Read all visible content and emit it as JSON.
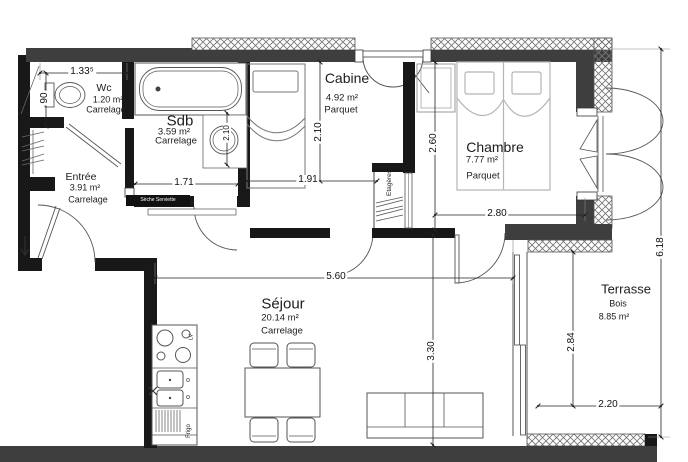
{
  "rooms": {
    "wc": {
      "name": "Wc",
      "area": "1.20 m²",
      "floor": "Carrelage"
    },
    "sdb": {
      "name": "Sdb",
      "area": "3.59 m²",
      "floor": "Carrelage"
    },
    "entree": {
      "name": "Entrée",
      "area": "3.91 m²",
      "floor": "Carrelage"
    },
    "cabine": {
      "name": "Cabine",
      "area": "4.92 m²",
      "floor": "Parquet"
    },
    "chambre": {
      "name": "Chambre",
      "area": "7.77 m²",
      "floor": "Parquet"
    },
    "sejour": {
      "name": "Séjour",
      "area": "20.14 m²",
      "floor": "Carrelage"
    },
    "terrasse": {
      "name": "Terrasse",
      "area": "8.85 m²",
      "floor": "Bois"
    }
  },
  "dimensions": {
    "wc_width": "1.33⁵",
    "wc_depth": "90",
    "sdb_width": "1.71",
    "sdb_depth": "2.10",
    "cabine_depth": "2.10",
    "cabine_width": "1.91",
    "chambre_depth": "2.60",
    "chambre_width": "2.80",
    "sejour_width": "5.60",
    "sejour_depth": "3.30",
    "terrasse_depth": "2.84",
    "terrasse_width": "2.20",
    "total_depth": "6.18"
  },
  "annotations": {
    "seche_serviette": "Sèche Serviette",
    "etageres": "Etagères",
    "frigo": "Frigo",
    "lave_vaisselle": "LV"
  },
  "colors": {
    "interior_wall": "#181818",
    "exterior_wall": "#3e3e3e",
    "background": "#ffffff"
  }
}
